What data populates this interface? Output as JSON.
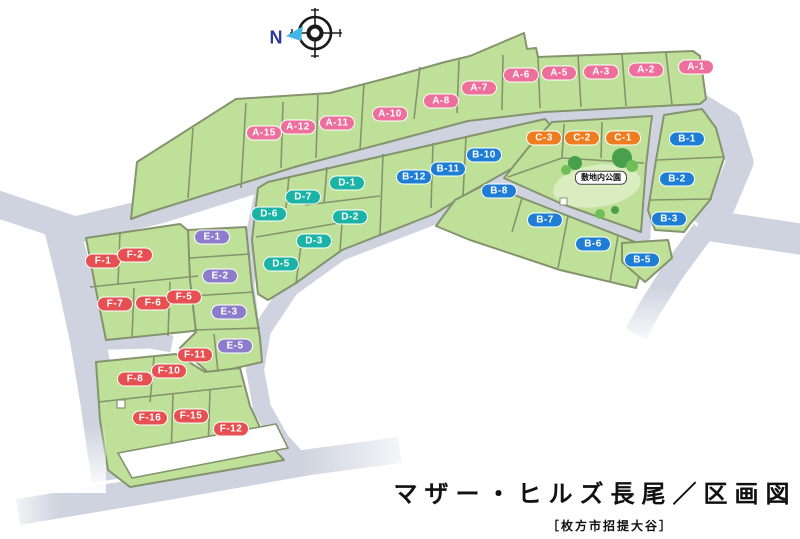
{
  "map": {
    "title": "マザー・ヒルズ長尾／区画図",
    "subtitle": "［枚方市招提大谷］",
    "compass_label": "N",
    "park_label": "敷地内公園",
    "colors": {
      "lot_green": "#bfe099",
      "road_gray": "#ced3df",
      "series": {
        "A": "#ee6f9b",
        "B": "#1e7ed6",
        "C": "#ef7d1f",
        "D": "#1ab3a6",
        "E": "#8c7ccb",
        "F": "#e65052"
      }
    },
    "lots": [
      {
        "id": "A-1",
        "series": "A",
        "label": "A-1",
        "x": 696,
        "y": 67
      },
      {
        "id": "A-2",
        "series": "A",
        "label": "A-2",
        "x": 646,
        "y": 70
      },
      {
        "id": "A-3",
        "series": "A",
        "label": "A-3",
        "x": 601,
        "y": 72
      },
      {
        "id": "A-5",
        "series": "A",
        "label": "A-5",
        "x": 559,
        "y": 73
      },
      {
        "id": "A-6",
        "series": "A",
        "label": "A-6",
        "x": 521,
        "y": 75
      },
      {
        "id": "A-7",
        "series": "A",
        "label": "A-7",
        "x": 479,
        "y": 88
      },
      {
        "id": "A-8",
        "series": "A",
        "label": "A-8",
        "x": 441,
        "y": 101
      },
      {
        "id": "A-10",
        "series": "A",
        "label": "A-10",
        "x": 390,
        "y": 114
      },
      {
        "id": "A-11",
        "series": "A",
        "label": "A-11",
        "x": 337,
        "y": 123
      },
      {
        "id": "A-12",
        "series": "A",
        "label": "A-12",
        "x": 298,
        "y": 127
      },
      {
        "id": "A-15",
        "series": "A",
        "label": "A-15",
        "x": 264,
        "y": 133
      },
      {
        "id": "C-3",
        "series": "C",
        "label": "C-3",
        "x": 544,
        "y": 138
      },
      {
        "id": "C-2",
        "series": "C",
        "label": "C-2",
        "x": 582,
        "y": 138
      },
      {
        "id": "C-1",
        "series": "C",
        "label": "C-1",
        "x": 623,
        "y": 138
      },
      {
        "id": "B-1",
        "series": "B",
        "label": "B-1",
        "x": 687,
        "y": 139
      },
      {
        "id": "B-2",
        "series": "B",
        "label": "B-2",
        "x": 677,
        "y": 179
      },
      {
        "id": "B-3",
        "series": "B",
        "label": "B-3",
        "x": 669,
        "y": 219
      },
      {
        "id": "B-5",
        "series": "B",
        "label": "B-5",
        "x": 642,
        "y": 260
      },
      {
        "id": "B-6",
        "series": "B",
        "label": "B-6",
        "x": 593,
        "y": 244
      },
      {
        "id": "B-7",
        "series": "B",
        "label": "B-7",
        "x": 545,
        "y": 220
      },
      {
        "id": "B-8",
        "series": "B",
        "label": "B-8",
        "x": 499,
        "y": 191
      },
      {
        "id": "B-10",
        "series": "B",
        "label": "B-10",
        "x": 484,
        "y": 155
      },
      {
        "id": "B-11",
        "series": "B",
        "label": "B-11",
        "x": 448,
        "y": 169
      },
      {
        "id": "B-12",
        "series": "B",
        "label": "B-12",
        "x": 414,
        "y": 177
      },
      {
        "id": "D-1",
        "series": "D",
        "label": "D-1",
        "x": 347,
        "y": 183
      },
      {
        "id": "D-7",
        "series": "D",
        "label": "D-7",
        "x": 303,
        "y": 197
      },
      {
        "id": "D-6",
        "series": "D",
        "label": "D-6",
        "x": 269,
        "y": 214
      },
      {
        "id": "D-2",
        "series": "D",
        "label": "D-2",
        "x": 350,
        "y": 217
      },
      {
        "id": "D-3",
        "series": "D",
        "label": "D-3",
        "x": 314,
        "y": 241
      },
      {
        "id": "D-5",
        "series": "D",
        "label": "D-5",
        "x": 281,
        "y": 264
      },
      {
        "id": "E-1",
        "series": "E",
        "label": "E-1",
        "x": 212,
        "y": 237
      },
      {
        "id": "E-2",
        "series": "E",
        "label": "E-2",
        "x": 220,
        "y": 276
      },
      {
        "id": "E-3",
        "series": "E",
        "label": "E-3",
        "x": 229,
        "y": 312
      },
      {
        "id": "E-5",
        "series": "E",
        "label": "E-5",
        "x": 235,
        "y": 346
      },
      {
        "id": "F-1",
        "series": "F",
        "label": "F-1",
        "x": 103,
        "y": 261
      },
      {
        "id": "F-2",
        "series": "F",
        "label": "F-2",
        "x": 135,
        "y": 255
      },
      {
        "id": "F-7",
        "series": "F",
        "label": "F-7",
        "x": 115,
        "y": 304
      },
      {
        "id": "F-6",
        "series": "F",
        "label": "F-6",
        "x": 153,
        "y": 303
      },
      {
        "id": "F-5",
        "series": "F",
        "label": "F-5",
        "x": 184,
        "y": 297
      },
      {
        "id": "F-11",
        "series": "F",
        "label": "F-11",
        "x": 195,
        "y": 355
      },
      {
        "id": "F-10",
        "series": "F",
        "label": "F-10",
        "x": 169,
        "y": 371
      },
      {
        "id": "F-8",
        "series": "F",
        "label": "F-8",
        "x": 135,
        "y": 379
      },
      {
        "id": "F-16",
        "series": "F",
        "label": "F-16",
        "x": 150,
        "y": 418
      },
      {
        "id": "F-15",
        "series": "F",
        "label": "F-15",
        "x": 191,
        "y": 416
      },
      {
        "id": "F-12",
        "series": "F",
        "label": "F-12",
        "x": 231,
        "y": 429
      }
    ]
  }
}
